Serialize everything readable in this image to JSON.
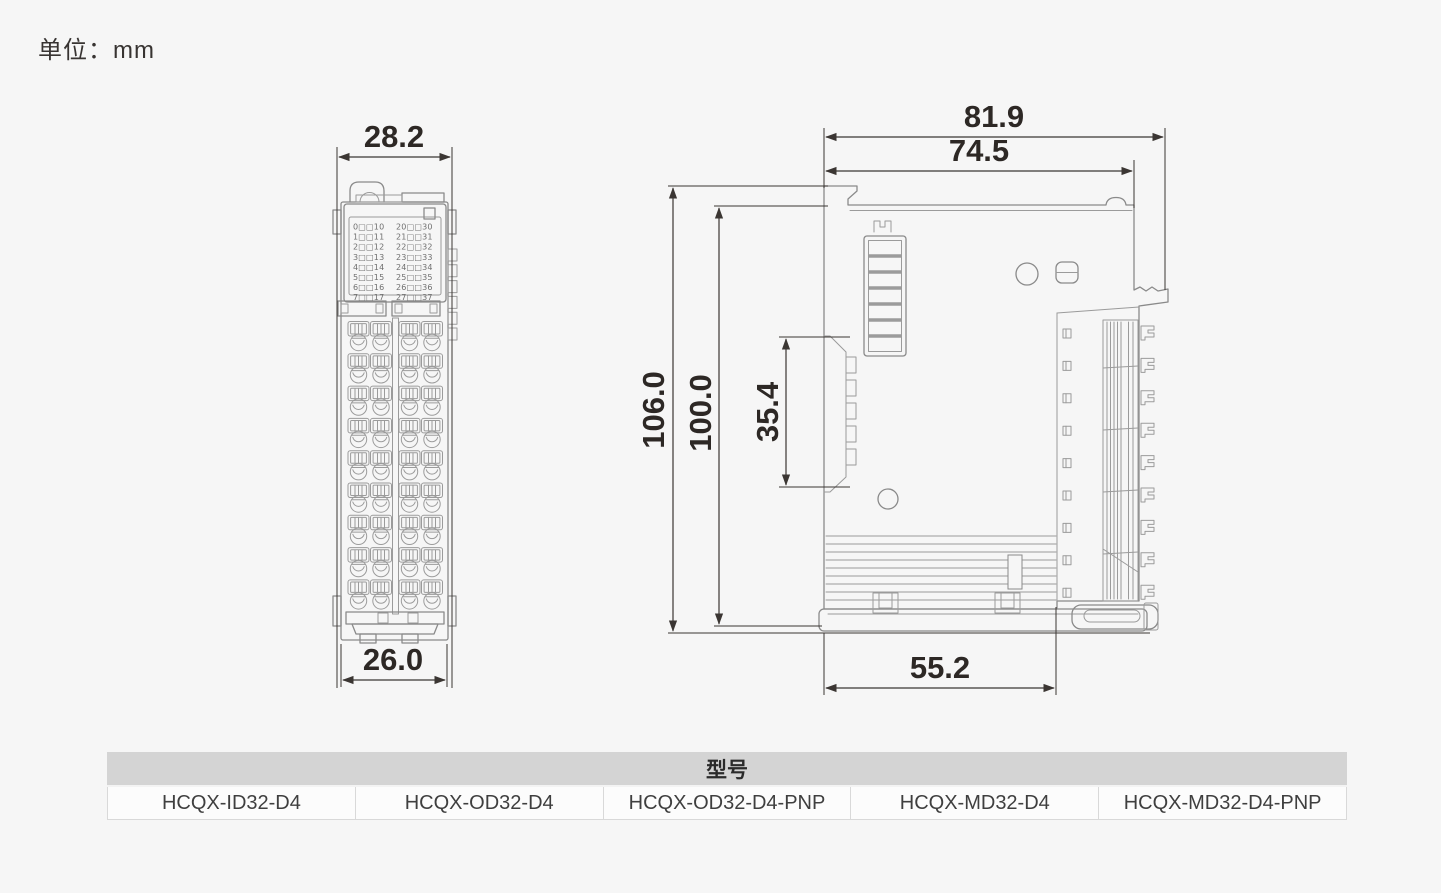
{
  "unit_label": "单位：mm",
  "front_view": {
    "dim_width_top": "28.2",
    "dim_width_bottom": "26.0",
    "channel_labels_left": [
      "0□□10",
      "1□□11",
      "2□□12",
      "3□□13",
      "4□□14",
      "5□□15",
      "6□□16",
      "7□□17"
    ],
    "channel_labels_right": [
      "20□□30",
      "21□□31",
      "22□□32",
      "23□□33",
      "24□□34",
      "25□□35",
      "26□□36",
      "27□□37"
    ]
  },
  "side_view": {
    "dim_width_total": "81.9",
    "dim_width_body": "74.5",
    "dim_height_total": "106.0",
    "dim_height_body": "100.0",
    "dim_din_clip_height": "35.4",
    "dim_depth_bottom": "55.2"
  },
  "model_table": {
    "header": "型号",
    "models": [
      "HCQX-ID32-D4",
      "HCQX-OD32-D4",
      "HCQX-OD32-D4-PNP",
      "HCQX-MD32-D4",
      "HCQX-MD32-D4-PNP"
    ]
  },
  "colors": {
    "background": "#f6f6f6",
    "outline_gray": "#8a8a8a",
    "dimension_ink": "#2d2825",
    "table_header_bg": "#d4d4d4",
    "table_cell_bg": "#fcfcfc"
  }
}
